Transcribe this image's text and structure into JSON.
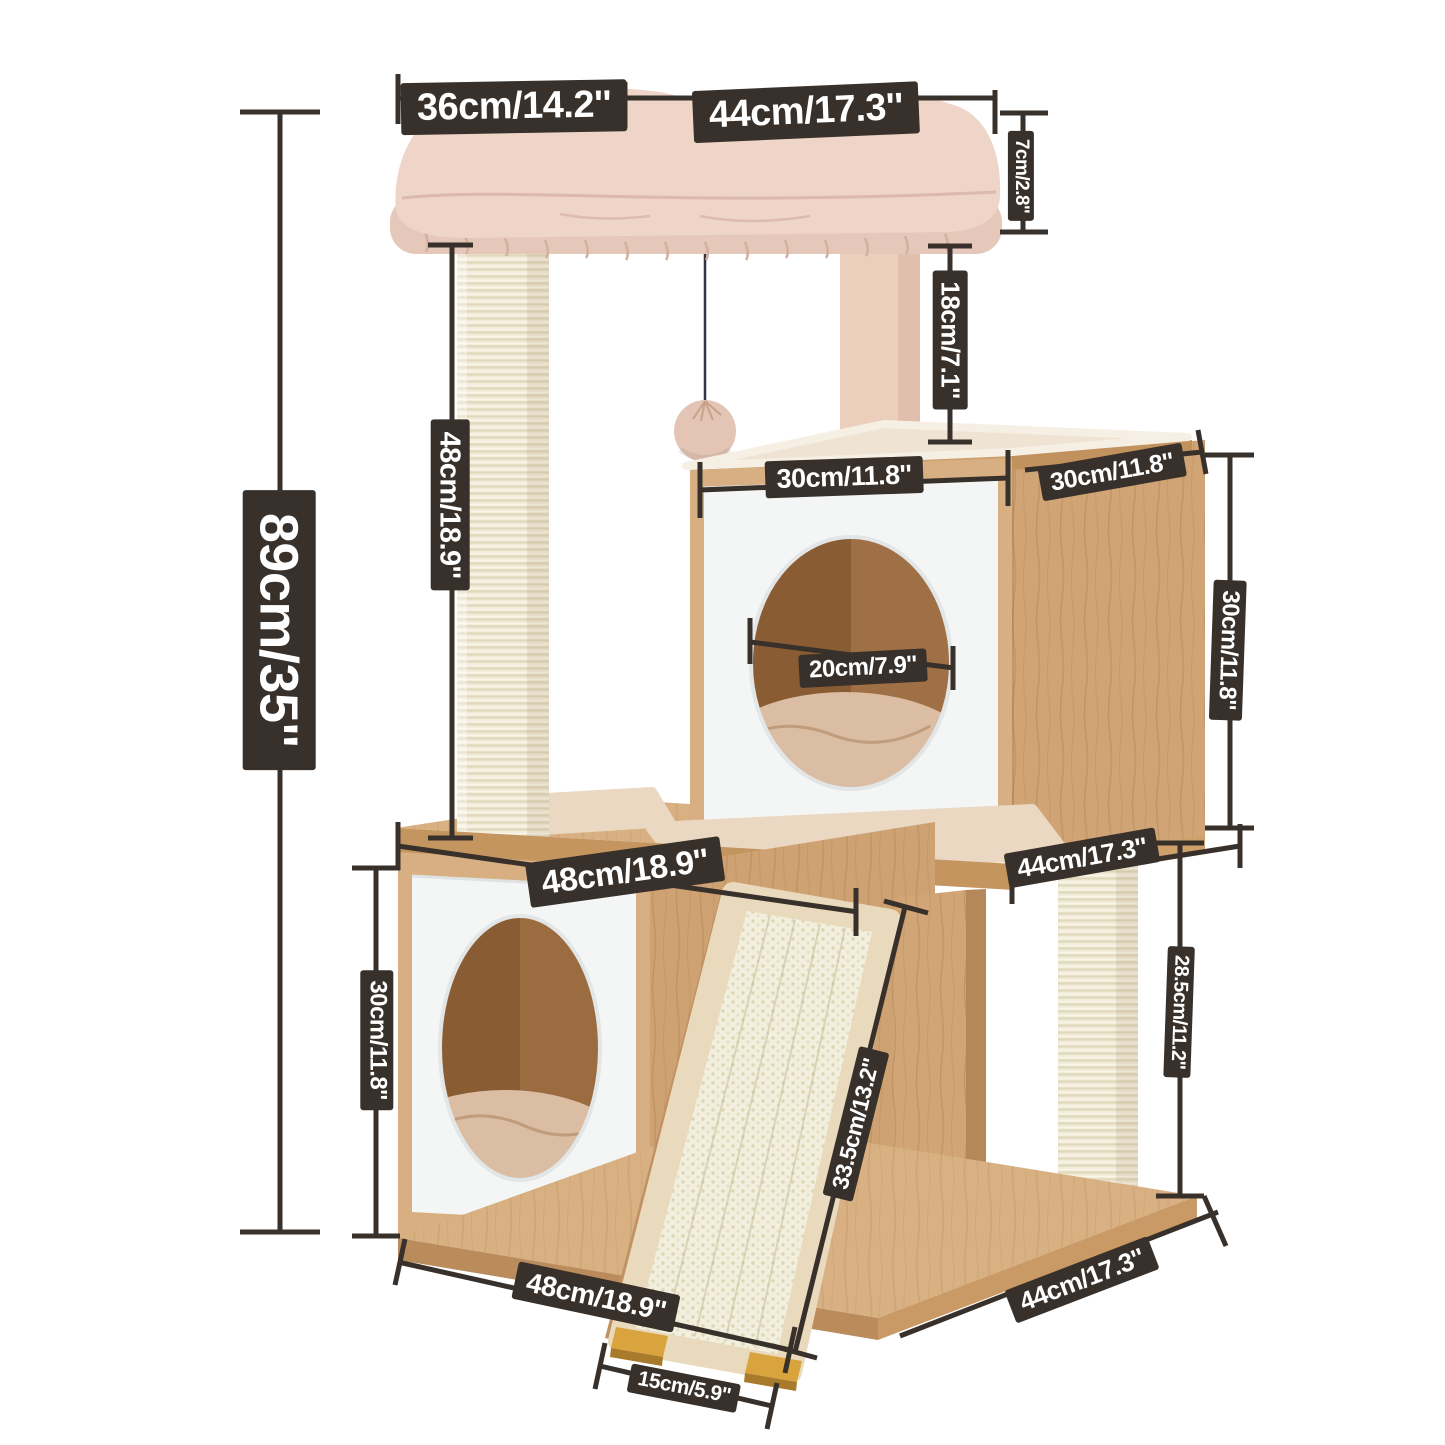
{
  "page": {
    "description": "Cat tree product dimensions diagram on white background"
  },
  "colors": {
    "label_bg": "#38302a",
    "label_text": "#ffffff",
    "wood": "#d8b082",
    "wood_edge": "#c5955f",
    "sisal": "#f2edda",
    "plush_bed": "#eed5c8",
    "white_panel": "#f4f6f5",
    "ramp_feet": "#d9a43d",
    "hole_interior": "#8a5c34"
  },
  "measurements": {
    "overall_height": "89cm/35''",
    "bed_width_left": "36cm/14.2''",
    "bed_width_right": "44cm/17.3''",
    "bed_thickness": "7cm/2.8''",
    "upper_post_height": "18cm/7.1''",
    "condo_width": "30cm/11.8''",
    "condo_depth": "30cm/11.8''",
    "condo_height": "30cm/11.8''",
    "hole_diameter": "20cm/7.9''",
    "left_post_height": "48cm/18.9''",
    "platform_width": "48cm/18.9''",
    "platform_depth": "44cm/17.3''",
    "lower_condo_height": "30cm/11.8''",
    "lower_post_height": "28.5cm/11.2''",
    "ramp_length": "33.5cm/13.2''",
    "base_width": "48cm/18.9''",
    "base_depth": "44cm/17.3''",
    "ramp_foot_spacing": "15cm/5.9''"
  }
}
